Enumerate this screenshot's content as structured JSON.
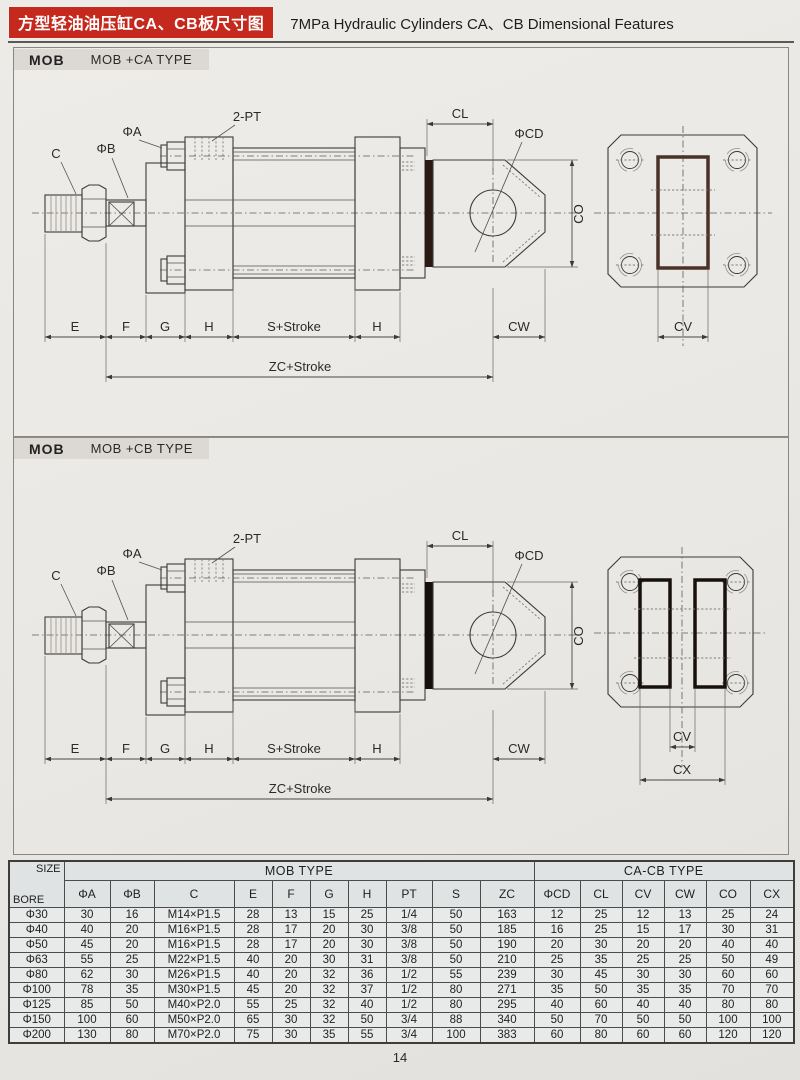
{
  "header": {
    "title_cn": "方型轻油油压缸CA、CB板尺寸图",
    "title_en": "7MPa Hydraulic Cylinders CA、CB Dimensional Features"
  },
  "sections": [
    {
      "tag": "MOB",
      "type_label": "MOB +CA TYPE"
    },
    {
      "tag": "MOB",
      "type_label": "MOB +CB TYPE"
    }
  ],
  "dims": {
    "c": "C",
    "phi_b": "ΦB",
    "phi_a": "ΦA",
    "two_pt": "2-PT",
    "cl": "CL",
    "phi_cd": "ΦCD",
    "co": "CO",
    "cw": "CW",
    "cv": "CV",
    "cx": "CX",
    "e": "E",
    "f": "F",
    "g": "G",
    "h": "H",
    "s_stroke": "S+Stroke",
    "zc_stroke": "ZC+Stroke"
  },
  "table": {
    "corner_top": "SIZE",
    "corner_bottom": "BORE",
    "groups": [
      {
        "label": "MOB TYPE"
      },
      {
        "label": "CA-CB TYPE"
      }
    ],
    "columns": [
      "ΦA",
      "ΦB",
      "C",
      "E",
      "F",
      "G",
      "H",
      "PT",
      "S",
      "ZC",
      "ΦCD",
      "CL",
      "CV",
      "CW",
      "CO",
      "CX"
    ],
    "rows": [
      [
        "Φ30",
        "30",
        "16",
        "M14×P1.5",
        "28",
        "13",
        "15",
        "25",
        "1/4",
        "50",
        "163",
        "12",
        "25",
        "12",
        "13",
        "25",
        "24"
      ],
      [
        "Φ40",
        "40",
        "20",
        "M16×P1.5",
        "28",
        "17",
        "20",
        "30",
        "3/8",
        "50",
        "185",
        "16",
        "25",
        "15",
        "17",
        "30",
        "31"
      ],
      [
        "Φ50",
        "45",
        "20",
        "M16×P1.5",
        "28",
        "17",
        "20",
        "30",
        "3/8",
        "50",
        "190",
        "20",
        "30",
        "20",
        "20",
        "40",
        "40"
      ],
      [
        "Φ63",
        "55",
        "25",
        "M22×P1.5",
        "40",
        "20",
        "30",
        "31",
        "3/8",
        "50",
        "210",
        "25",
        "35",
        "25",
        "25",
        "50",
        "49"
      ],
      [
        "Φ80",
        "62",
        "30",
        "M26×P1.5",
        "40",
        "20",
        "32",
        "36",
        "1/2",
        "55",
        "239",
        "30",
        "45",
        "30",
        "30",
        "60",
        "60"
      ],
      [
        "Φ100",
        "78",
        "35",
        "M30×P1.5",
        "45",
        "20",
        "32",
        "37",
        "1/2",
        "80",
        "271",
        "35",
        "50",
        "35",
        "35",
        "70",
        "70"
      ],
      [
        "Φ125",
        "85",
        "50",
        "M40×P2.0",
        "55",
        "25",
        "32",
        "40",
        "1/2",
        "80",
        "295",
        "40",
        "60",
        "40",
        "40",
        "80",
        "80"
      ],
      [
        "Φ150",
        "100",
        "60",
        "M50×P2.0",
        "65",
        "30",
        "32",
        "50",
        "3/4",
        "88",
        "340",
        "50",
        "70",
        "50",
        "50",
        "100",
        "100"
      ],
      [
        "Φ200",
        "130",
        "80",
        "M70×P2.0",
        "75",
        "30",
        "35",
        "55",
        "3/4",
        "100",
        "383",
        "60",
        "80",
        "60",
        "60",
        "120",
        "120"
      ]
    ]
  },
  "footer": {
    "page_number": "14"
  },
  "colors": {
    "accent_red": "#c5281c",
    "slot_ca_border": "#4a3228",
    "slot_cb_border": "#17100d",
    "end_plate_bar": "#2a1a13"
  }
}
